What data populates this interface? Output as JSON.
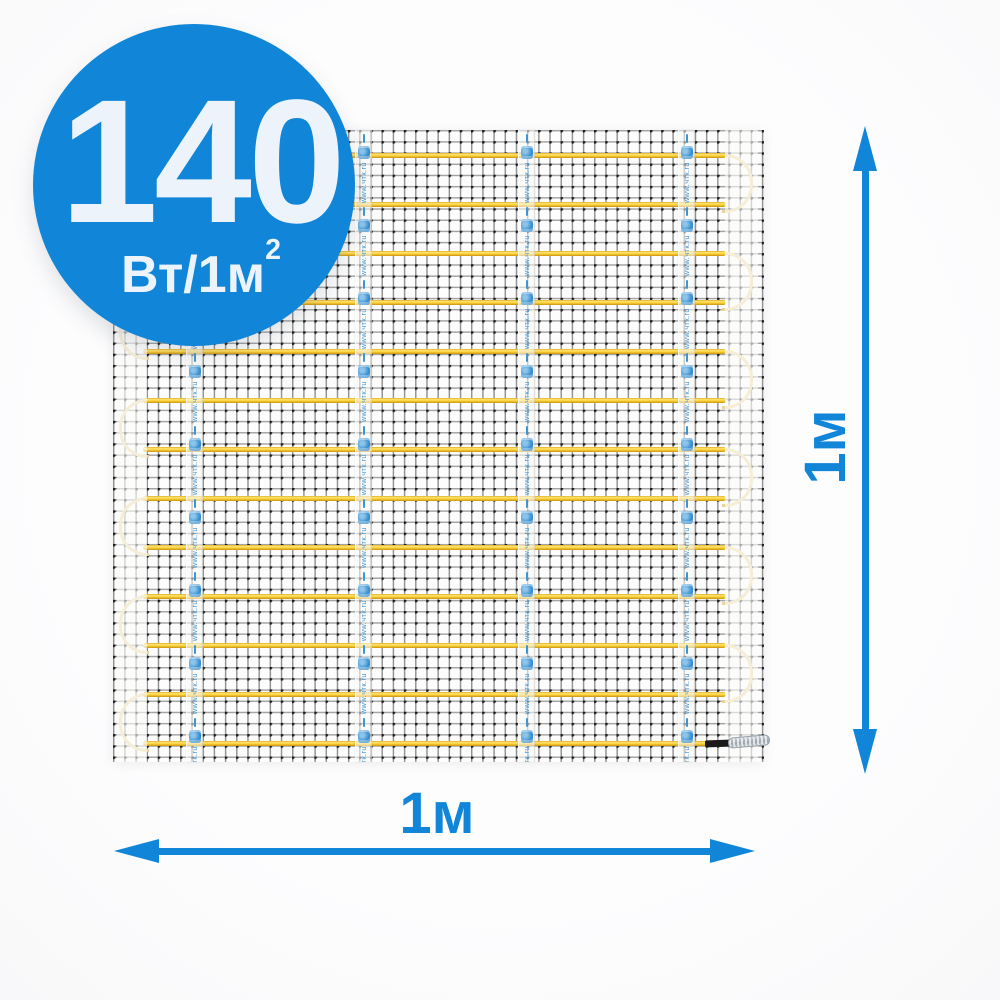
{
  "badge": {
    "value": "140",
    "unit": "Вт/1м",
    "unit_superscript": "2"
  },
  "dimensions": {
    "width_label": "1м",
    "height_label": "1м"
  },
  "mat": {
    "cable_rows": 13,
    "tape_count": 4,
    "tape_url": "www.чтк.ru"
  },
  "colors": {
    "accent_blue": "#1186d9",
    "badge_text": "#edf3fb",
    "cable_yellow": "#ffd23c",
    "cable_loop": "#e9d49c",
    "tape_blue": "#3d95d4",
    "connector_sleeve": "#1a1a1a",
    "connector_body": "#b3bcc3"
  }
}
